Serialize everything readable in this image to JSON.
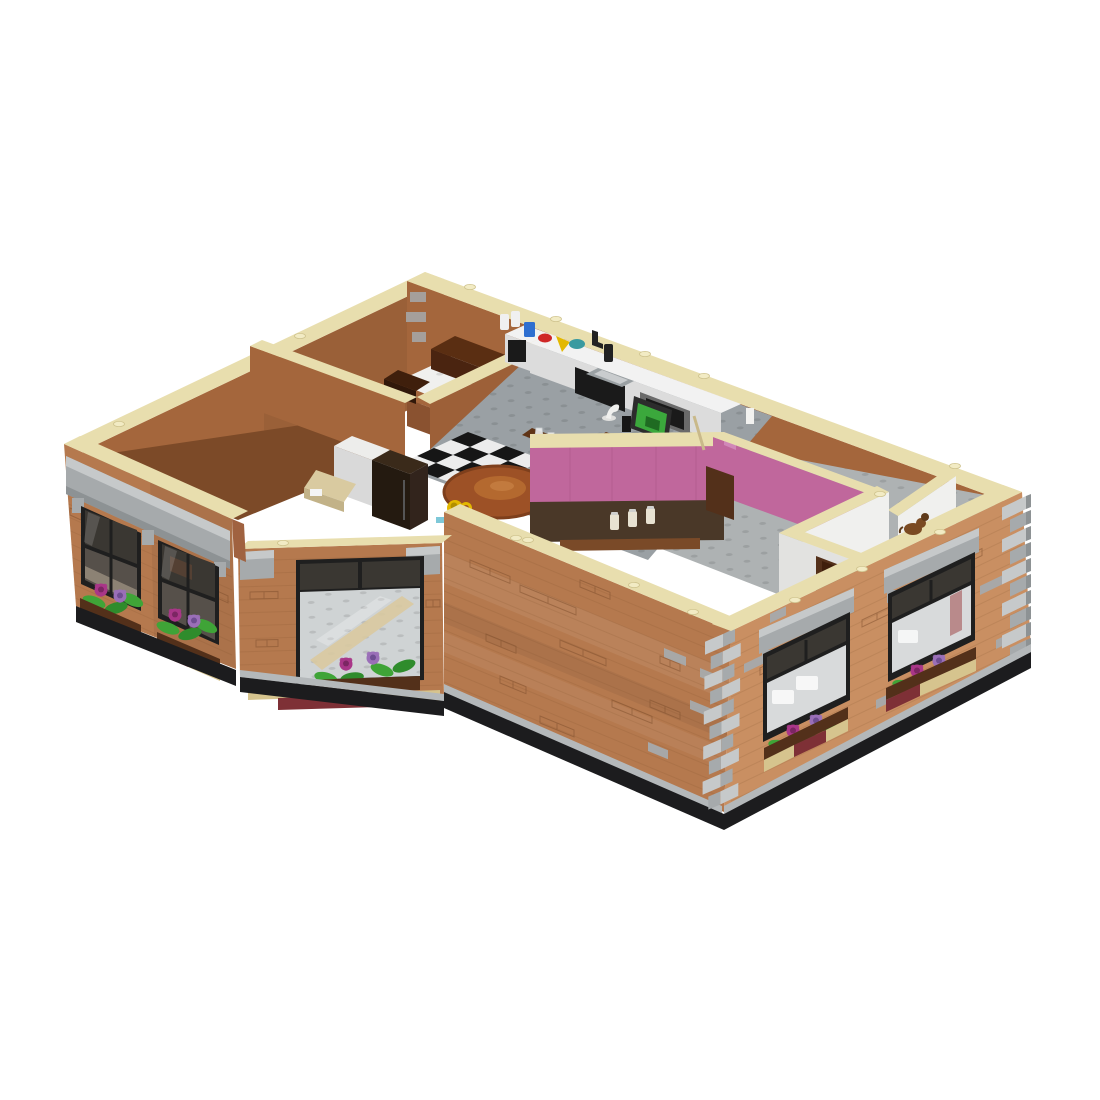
{
  "scene": {
    "description": "Isometric 3D render of a LEGO apartment floor module (Friends-style apartment) with open top, tan wall copings, brown brick facades with gray stone quoins, windows with purple and magenta flower boxes, interior kitchen with checkered floor, pink hallway walls and white bedroom walls, on a plain white background",
    "background": "#ffffff",
    "visible_items": [
      "tan coping on all wall tops",
      "brown brick exterior facades with embossed brick texture",
      "gray stone corner quoins and window cornices",
      "dark-framed windows with flower boxes of magenta and purple flowers and green leaves",
      "angled bay window showing gray studded floor inside",
      "rear glass window wall with silver mullions",
      "back-left room with dark brown vanity furniture",
      "kitchen with white L-counter, black stove, gray oven, sink, bottles and jars",
      "black-and-white checkered kitchen tile patch",
      "round brown table with plate and yellow mug",
      "white cabinet and dark refrigerator",
      "dark TV cabinet",
      "desk with black laptop showing green screen and white lamp",
      "row of clear glasses on a shelf",
      "pink hallway walls with shelf of cream jars",
      "white bedroom partition walls with reddish-brown doors",
      "small brown dog figure on the right wall coping",
      "gray sidewalk strip and black baseplate"
    ]
  },
  "colors": {
    "bgWhite": "#ffffff",
    "brick": "#b5794e",
    "brickLight": "#c98f62",
    "brickDark": "#a06240",
    "brickLine": "#7e4e2c",
    "tan": "#e8deae",
    "tanShadow": "#cfc38e",
    "tanStud": "#f2ebc4",
    "gray": "#a6aaac",
    "grayLight": "#c6c9ca",
    "grayDark": "#8d9294",
    "sidewalk": "#b4b8ba",
    "baseBlack": "#1c1c1e",
    "frame": "#1f1f1f",
    "glassDark": "#3a3732",
    "glassMid": "#56504a",
    "glassPale": "#d8dadb",
    "glassTint": "#fbfcfc",
    "intBrown": "#a4663c",
    "intBrownDark": "#8a5230",
    "intShadow": "#7c4a28",
    "partBrown": "#9d6038",
    "white": "#f0f0ee",
    "whiteShade": "#e2e2e0",
    "whiteDark": "#cfcfcd",
    "pink": "#c0679c",
    "pinkLight": "#d187b8",
    "floorGray": "#aeb2b3",
    "floorKitchen": "#9aa0a4",
    "checkDark": "#161616",
    "checkLight": "#ececec",
    "wood": "#6b3a1a",
    "woodDark": "#53301a",
    "woodDeep": "#3f1f0c",
    "counter": "#f2f2f2",
    "counterFront": "#dcdcdc",
    "appliance": "#1a1a1a",
    "steel": "#9aa0a3",
    "table": "#9d5126",
    "plate": "#b4692f",
    "plateHi": "#c27a3e",
    "mugYellow": "#e3b800",
    "aqua": "#7ec8d8",
    "leaf": "#3fa437",
    "leafDark": "#2f8c2c",
    "magenta": "#a93688",
    "magentaDark": "#7c2663",
    "purple": "#9a6fb8",
    "purpleDark": "#6f4e92",
    "plantBrown": "#53301a",
    "plantRed": "#7e3036",
    "plantTan": "#d6c48e",
    "blue": "#2f6fd0",
    "red": "#cf2727",
    "teal": "#3a9aa0",
    "screenGreen": "#3ba83c",
    "screenGreenD": "#1f6b22",
    "cream": "#e8e2d2",
    "paleWood": "#b9ab97",
    "shelfBrown": "#5f3416",
    "hallDark": "#4a3828",
    "dog": "#7a4a22",
    "dogDark": "#5f3a1a"
  }
}
